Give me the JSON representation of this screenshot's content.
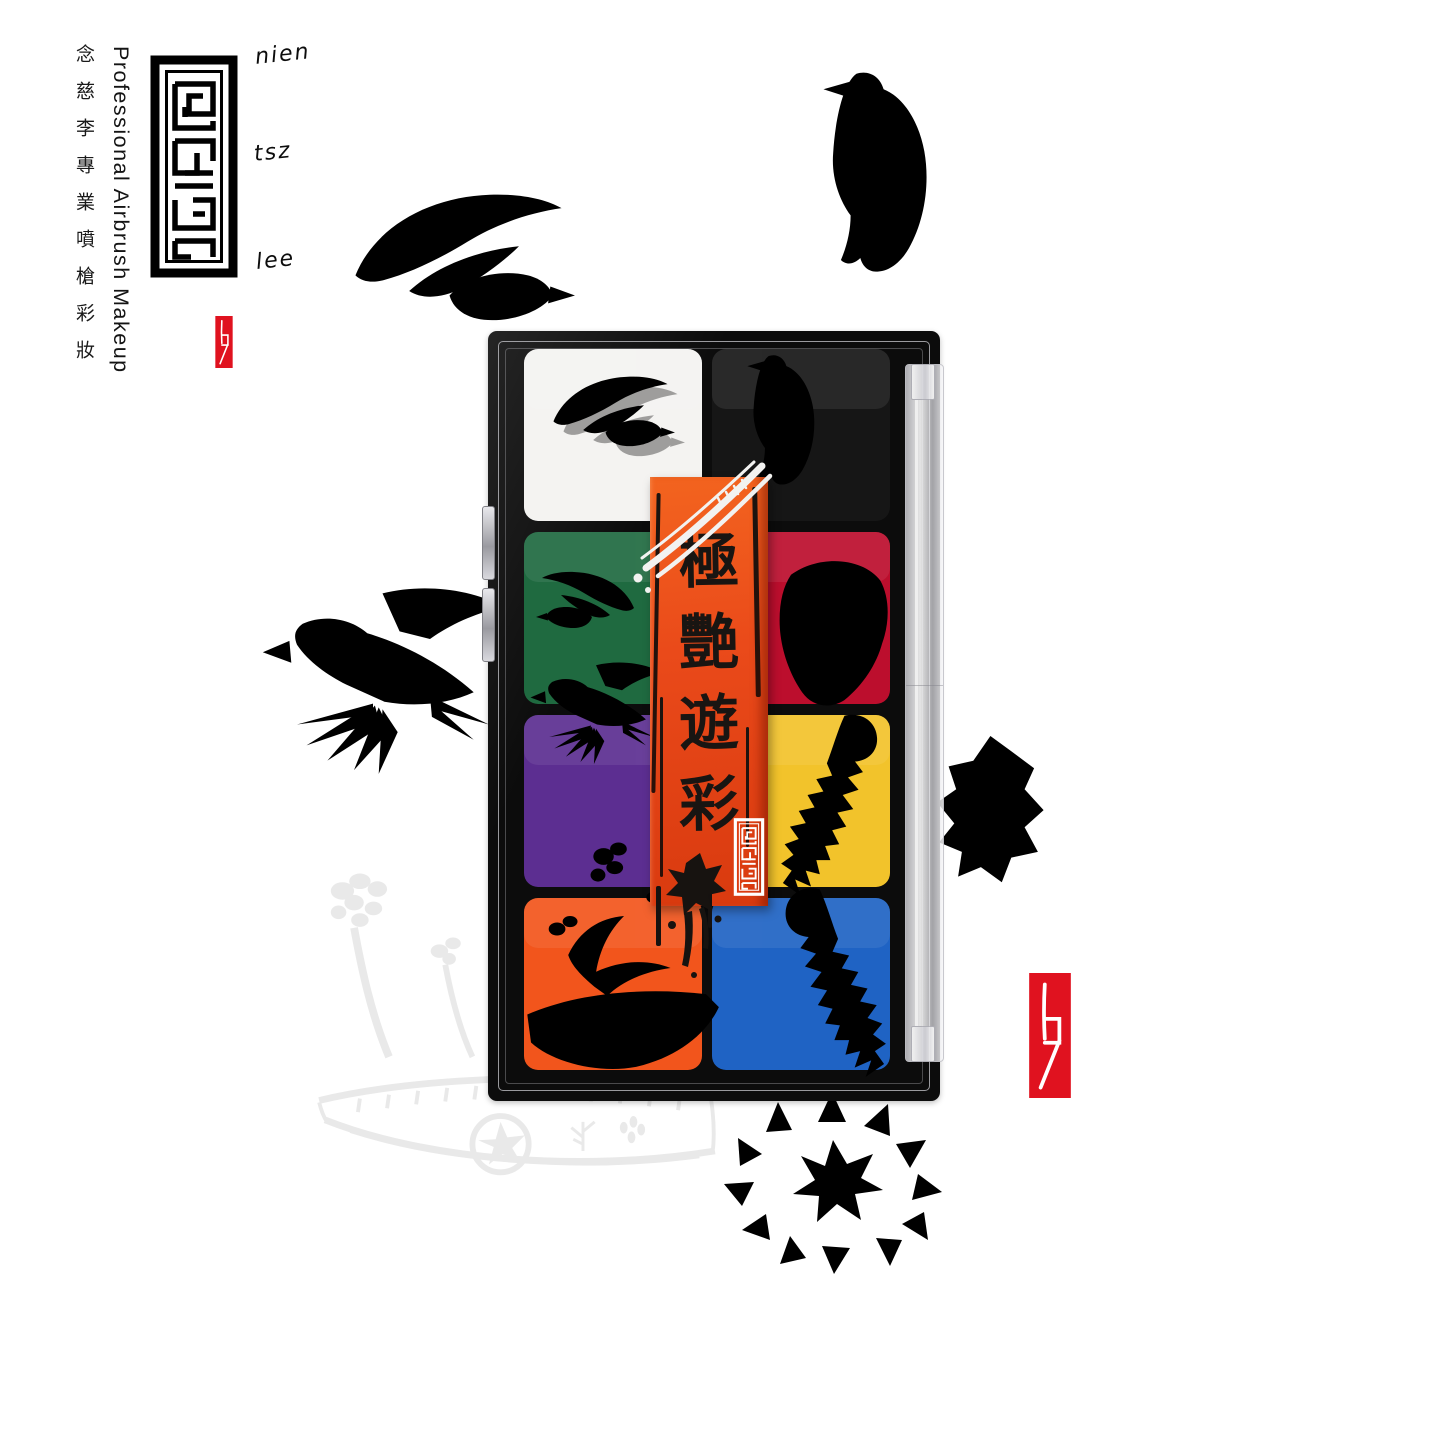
{
  "page": {
    "background": "#ffffff"
  },
  "colors": {
    "motif_gray": "#e9e9e9",
    "seal_red": "#e0121f",
    "banner_orange": "#ea4a1a",
    "case_black": "#0c0c0c",
    "cutout_black": "#1c1c1c",
    "pheasant_silver": "#d9d9d9"
  },
  "brand": {
    "logo": "maze-seal",
    "chinese_vertical": "念慈李專業噴槍彩妝",
    "english_vertical": "Professional Airbrush Makeup",
    "signature": {
      "word1": "nien",
      "word2": "tsz",
      "word3": "lee"
    },
    "artist_seal": "b7-seal"
  },
  "banner": {
    "title": "極艷遊彩",
    "chars": [
      "極",
      "艷",
      "遊",
      "彩"
    ],
    "stamp": "maze-seal-white"
  },
  "palette": {
    "pans": [
      {
        "name": "white",
        "color": "#f4f3f1",
        "motif": "ink-swallow"
      },
      {
        "name": "black",
        "color": "#161616",
        "motif": "silver-pheasant"
      },
      {
        "name": "green",
        "color": "#1f6a40",
        "motif": "paper-cut-doves"
      },
      {
        "name": "red",
        "color": "#bc0e2d",
        "motif": "opera-mask"
      },
      {
        "name": "purple",
        "color": "#5c2e91",
        "motif": "dove-wing"
      },
      {
        "name": "yellow",
        "color": "#f2c32b",
        "motif": "seahorse"
      },
      {
        "name": "orange",
        "color": "#f2551c",
        "motif": "dragon-boat"
      },
      {
        "name": "blue",
        "color": "#1f63c4",
        "motif": "seahorse-curl"
      }
    ]
  },
  "background_motifs": [
    "swallow",
    "pheasant",
    "dove",
    "chameleon",
    "dragon-boat",
    "sun-wheel"
  ]
}
